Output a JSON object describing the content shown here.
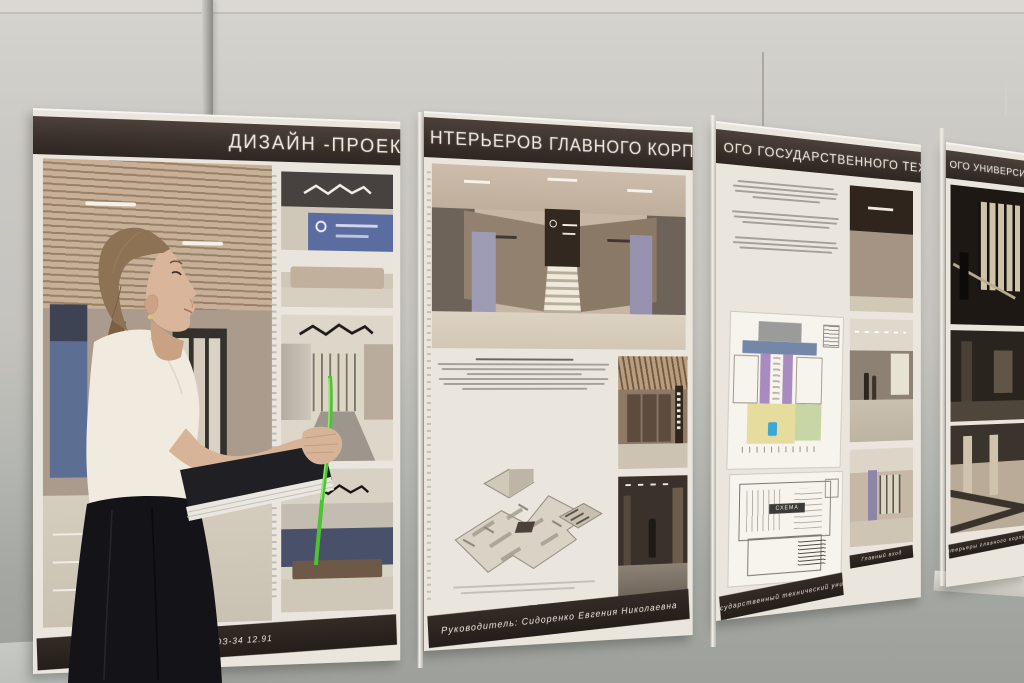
{
  "poster": {
    "full_title": "ДИЗАЙН-ПРОЕКТ ИНТЕРЬЕРОВ ГЛАВНОГО КОРПУСА ОМСКОГО ГОСУДАРСТВЕННОГО ТЕХНИЧЕСКОГО УНИВЕРСИТЕТА",
    "panels": [
      {
        "header_text": "ДИЗАЙН -ПРОЕКТ И",
        "footer_text": "11.90.10    ЮЗ-34  12.91"
      },
      {
        "header_text": "НТЕРЬЕРОВ ГЛАВНОГО КОРПУСА ОМС",
        "footer_text": "Руководитель: Сидоренко Евгения Николаевна"
      },
      {
        "header_text": "ОГО ГОСУДАРСТВЕННОГО ТЕХНИЧЕС",
        "footer_text": "Омский государственный технический университет"
      },
      {
        "header_text": "ОГО УНИВЕРСИТЕ",
        "footer_text": "Интерьеры главного корпуса"
      }
    ],
    "captions": {
      "panel_c_right": "Главный вход"
    },
    "plan_label": "СХЕМА",
    "colors": {
      "header_band": "#3a312b",
      "board": "#ebe7df",
      "accent_lavender": "#9e9cb4",
      "accent_blue_wall": "#5b6ca0",
      "plan_purple": "#a98bc0",
      "plan_blue": "#7387a8",
      "plan_yellow": "#e5dc9e",
      "plan_green": "#c7d6a4",
      "plan_marker": "#3fa7d6",
      "pointer_green": "#4ec234"
    }
  }
}
